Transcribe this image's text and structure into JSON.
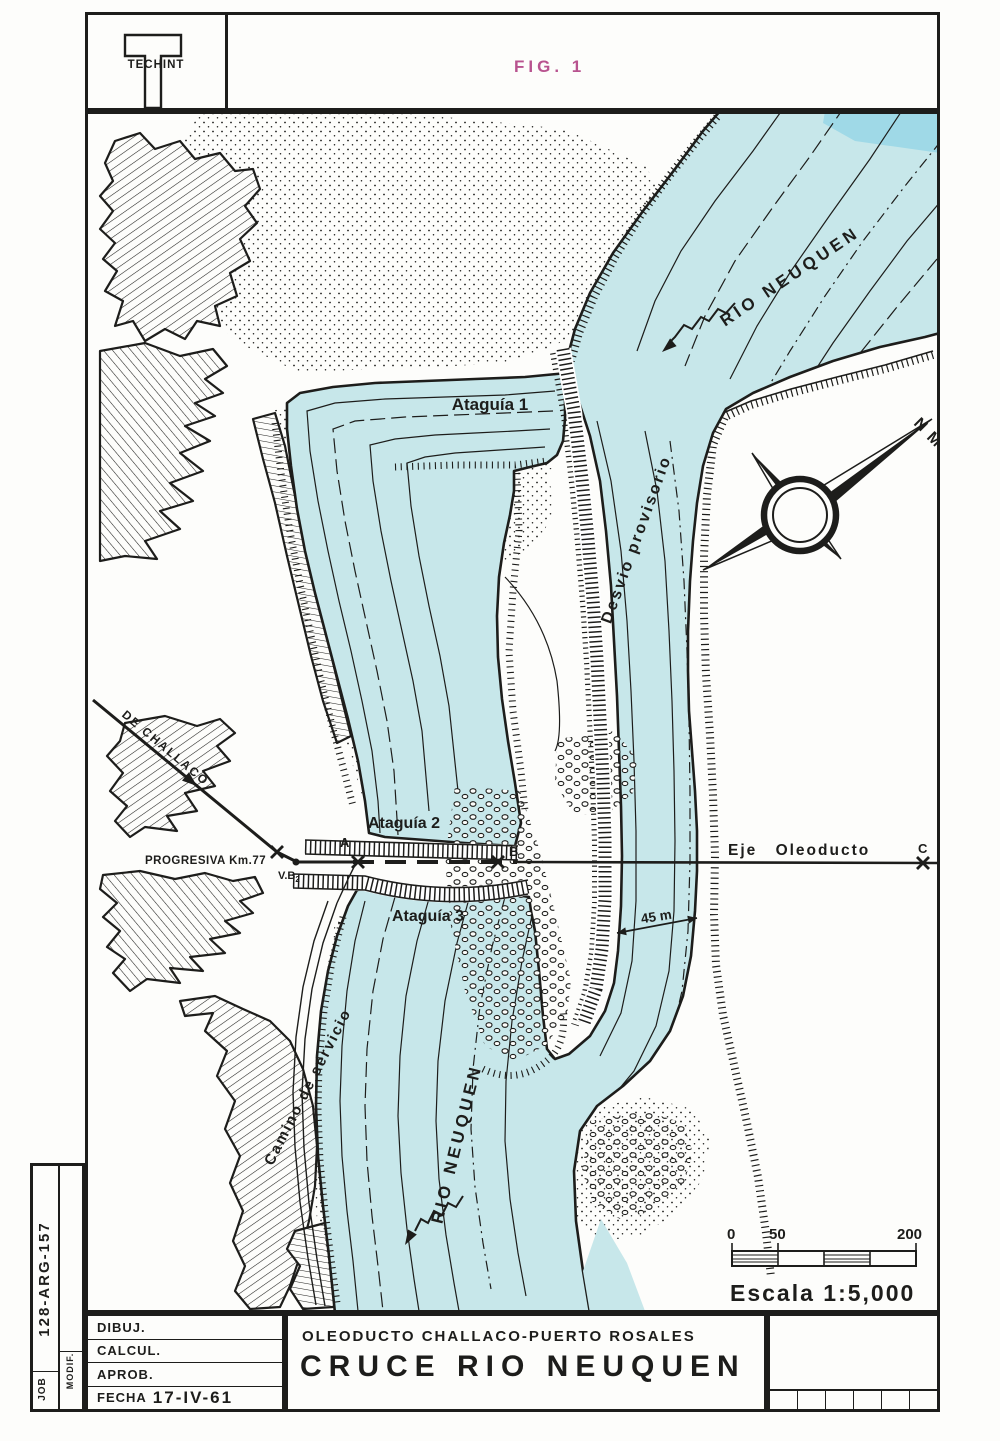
{
  "header": {
    "logo_text": "TECHINT",
    "figure_label": "FIG. 1"
  },
  "map": {
    "labels": {
      "rio_neuquen_upper": "RIO NEUQUEN",
      "rio_neuquen_lower": "RIO NEUQUEN",
      "ataguia_1": "Ataguía 1",
      "ataguia_2": "Ataguía 2",
      "ataguia_3": "Ataguía 3",
      "desvio_provisorio": "Desvio provisorio",
      "de_challaco": "DE CHALLACO",
      "progresiva": "PROGRESIVA Km.77",
      "eje_oleoducto": "Eje Oleoducto",
      "camino_de_servicio": "Camino de servicio",
      "channel_width": "45 m",
      "point_a": "A",
      "point_b": "B",
      "point_c": "C",
      "vertice": "V.B",
      "vertice_sub": "2",
      "compass_n": "N",
      "compass_m": "M"
    },
    "scale": {
      "tick_0": "0",
      "tick_50": "50",
      "tick_200": "200",
      "caption": "Escala 1:5,000"
    }
  },
  "title_block": {
    "job_label": "JOB",
    "job_number": "128-ARG-157",
    "modif_label": "MODIF.",
    "rows": [
      {
        "label": "DIBUJ.",
        "value": ""
      },
      {
        "label": "CALCUL.",
        "value": ""
      },
      {
        "label": "APROB.",
        "value": ""
      },
      {
        "label": "FECHA",
        "value": "17-IV-61"
      }
    ],
    "project_line": "OLEODUCTO CHALLACO-PUERTO ROSALES",
    "drawing_title": "CRUCE RIO NEUQUEN"
  },
  "colors": {
    "water": "#c7e7ea",
    "water_dark": "#9fd9e7",
    "ink": "#1d1d1b",
    "figure_pink": "#b8538f",
    "paper": "#fdfdfb"
  }
}
